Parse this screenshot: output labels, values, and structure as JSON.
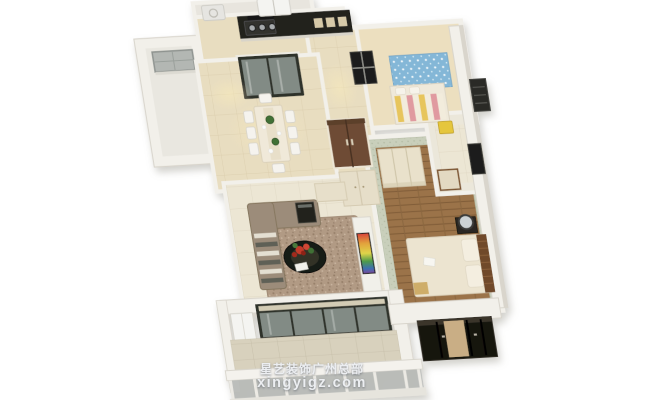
{
  "scene": {
    "description": "3D bird's-eye rendering of an apartment floor plan",
    "rooms": [
      "utility-balcony",
      "kitchen",
      "dining-room",
      "hallway",
      "kids-bedroom",
      "bathroom",
      "master-bedroom",
      "living-room",
      "balcony"
    ]
  },
  "watermark": {
    "line1": "星艺装饰广州总部",
    "line2": "xingyigz.com"
  },
  "palette": {
    "bg": "#ffffff",
    "wall": "#f2f0ea",
    "wall_shade": "#d9d5cc",
    "tile_warm": "#e8ddc0",
    "tile_cream": "#ece6d4",
    "marble": "#d8d1bd",
    "wood": "#9b7348",
    "cabinet_dark": "#23221e",
    "glass_frame": "#2f302b",
    "glass_pane": "#828b85",
    "blue_wall": "#84b7d7",
    "sage_wall": "#c9cfbb",
    "bed_cream": "#ece4d0",
    "headboard_brown": "#6f4a2c",
    "stripe_yellow": "#e7c55c",
    "stripe_pink": "#e09aa0",
    "sofa_taupe": "#9c8c7a",
    "rug_brown": "#b19a84",
    "coffee_table_black": "#191a17",
    "plant_red": "#c23a2a",
    "plant_green": "#3f7036",
    "stool_yellow": "#e5c63d",
    "wardrobe_black": "#17140f",
    "wardrobe_tan": "#c9ae85",
    "appliance_white": "#f4f4f1",
    "watermark_text": "#eceef1"
  }
}
